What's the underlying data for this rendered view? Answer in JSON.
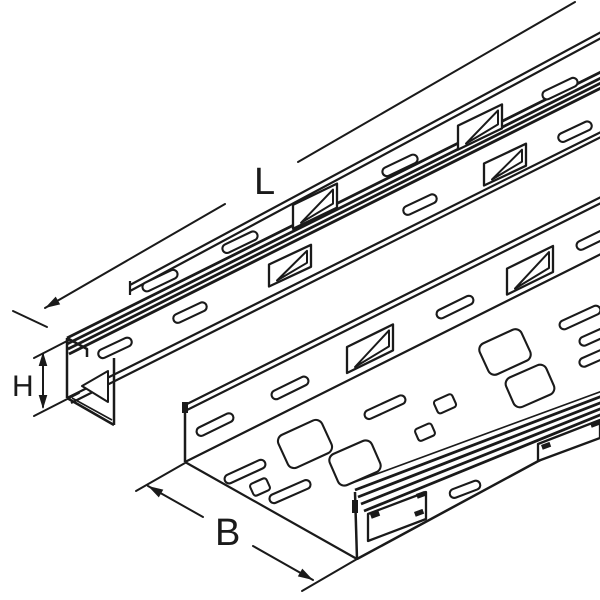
{
  "figure": {
    "kind": "technical line drawing",
    "subject": "perforated cable trays, isometric view"
  },
  "labels": {
    "length": "L",
    "height": "H",
    "width": "B"
  },
  "colors": {
    "line": "#1a1a1a",
    "background": "#ffffff"
  }
}
